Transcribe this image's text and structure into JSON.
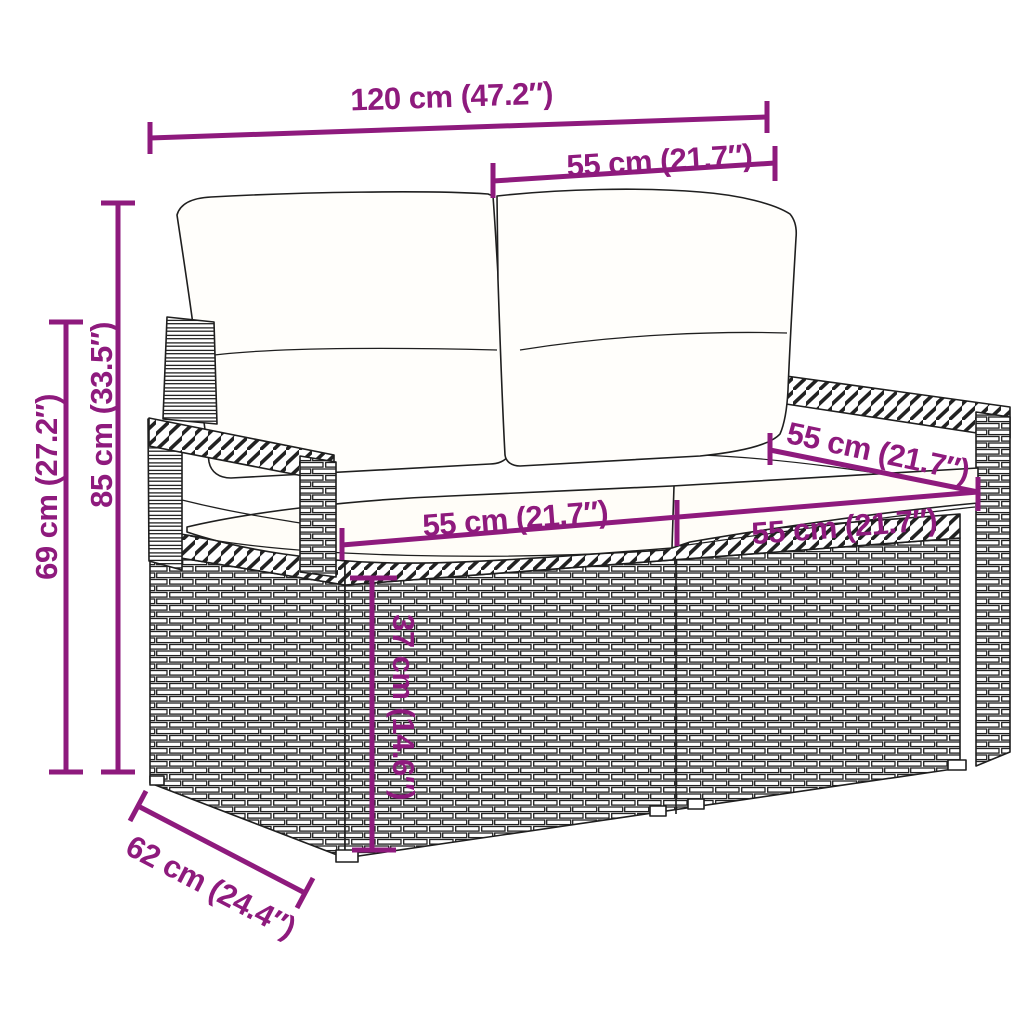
{
  "colors": {
    "dimension": "#8e1a7d",
    "line_art": "#1f1f1f",
    "background": "#ffffff",
    "cushion": "#fffdf8"
  },
  "diagram": {
    "subject": "two-seater-rattan-garden-sofa-with-cushions",
    "labels": {
      "width_total": "120 cm (47.2″)",
      "width_seat_top": "55 cm (21.7″)",
      "height_total": "85 cm (33.5″)",
      "height_arm": "69 cm (27.2″)",
      "width_seat_left": "55 cm (21.7″)",
      "width_seat_right": "55 cm (21.7″)",
      "depth_seat": "55 cm (21.7″)",
      "height_seat": "37 cm (14.6″)",
      "depth_total": "62 cm (24.4″)"
    }
  }
}
